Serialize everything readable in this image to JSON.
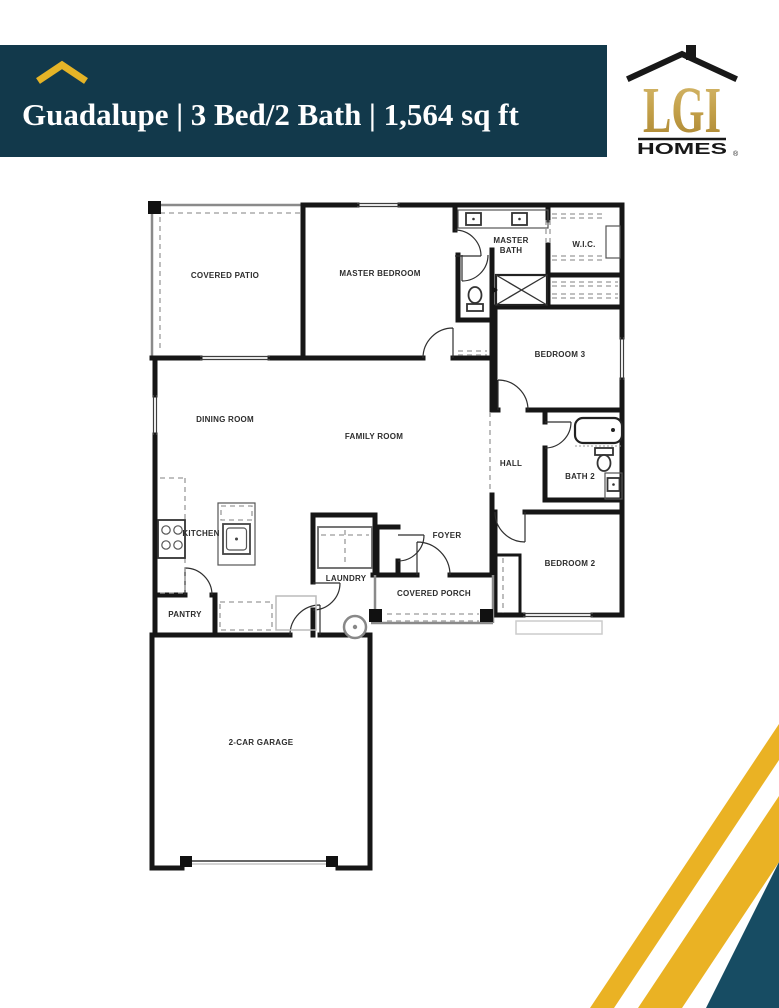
{
  "header": {
    "title": "Guadalupe | 3 Bed/2 Bath | 1,564 sq ft",
    "plan_name": "Guadalupe",
    "beds_baths": "3 Bed/2 Bath",
    "square_feet": "1,564 sq ft",
    "background_color": "#12394B",
    "text_color": "#FFFFFF",
    "accent_gold": "#E5B427"
  },
  "logo": {
    "brand": "LGI",
    "wordmark": "HOMES",
    "registered_mark": "®"
  },
  "floor_plan": {
    "rooms": {
      "covered_patio": "COVERED PATIO",
      "master_bedroom": "MASTER BEDROOM",
      "master_bath_line1": "MASTER",
      "master_bath_line2": "BATH",
      "walk_in_closet": "W.I.C.",
      "bedroom_3": "BEDROOM 3",
      "dining_room": "DINING ROOM",
      "family_room": "FAMILY ROOM",
      "kitchen": "KITCHEN",
      "pantry": "PANTRY",
      "laundry": "LAUNDRY",
      "foyer": "FOYER",
      "covered_porch": "COVERED PORCH",
      "hall": "HALL",
      "bath_2": "BATH 2",
      "bedroom_2": "BEDROOM 2",
      "garage": "2-CAR GARAGE"
    }
  },
  "decor": {
    "stripe_gold": "#EAB224",
    "corner_navy": "#174C63"
  }
}
